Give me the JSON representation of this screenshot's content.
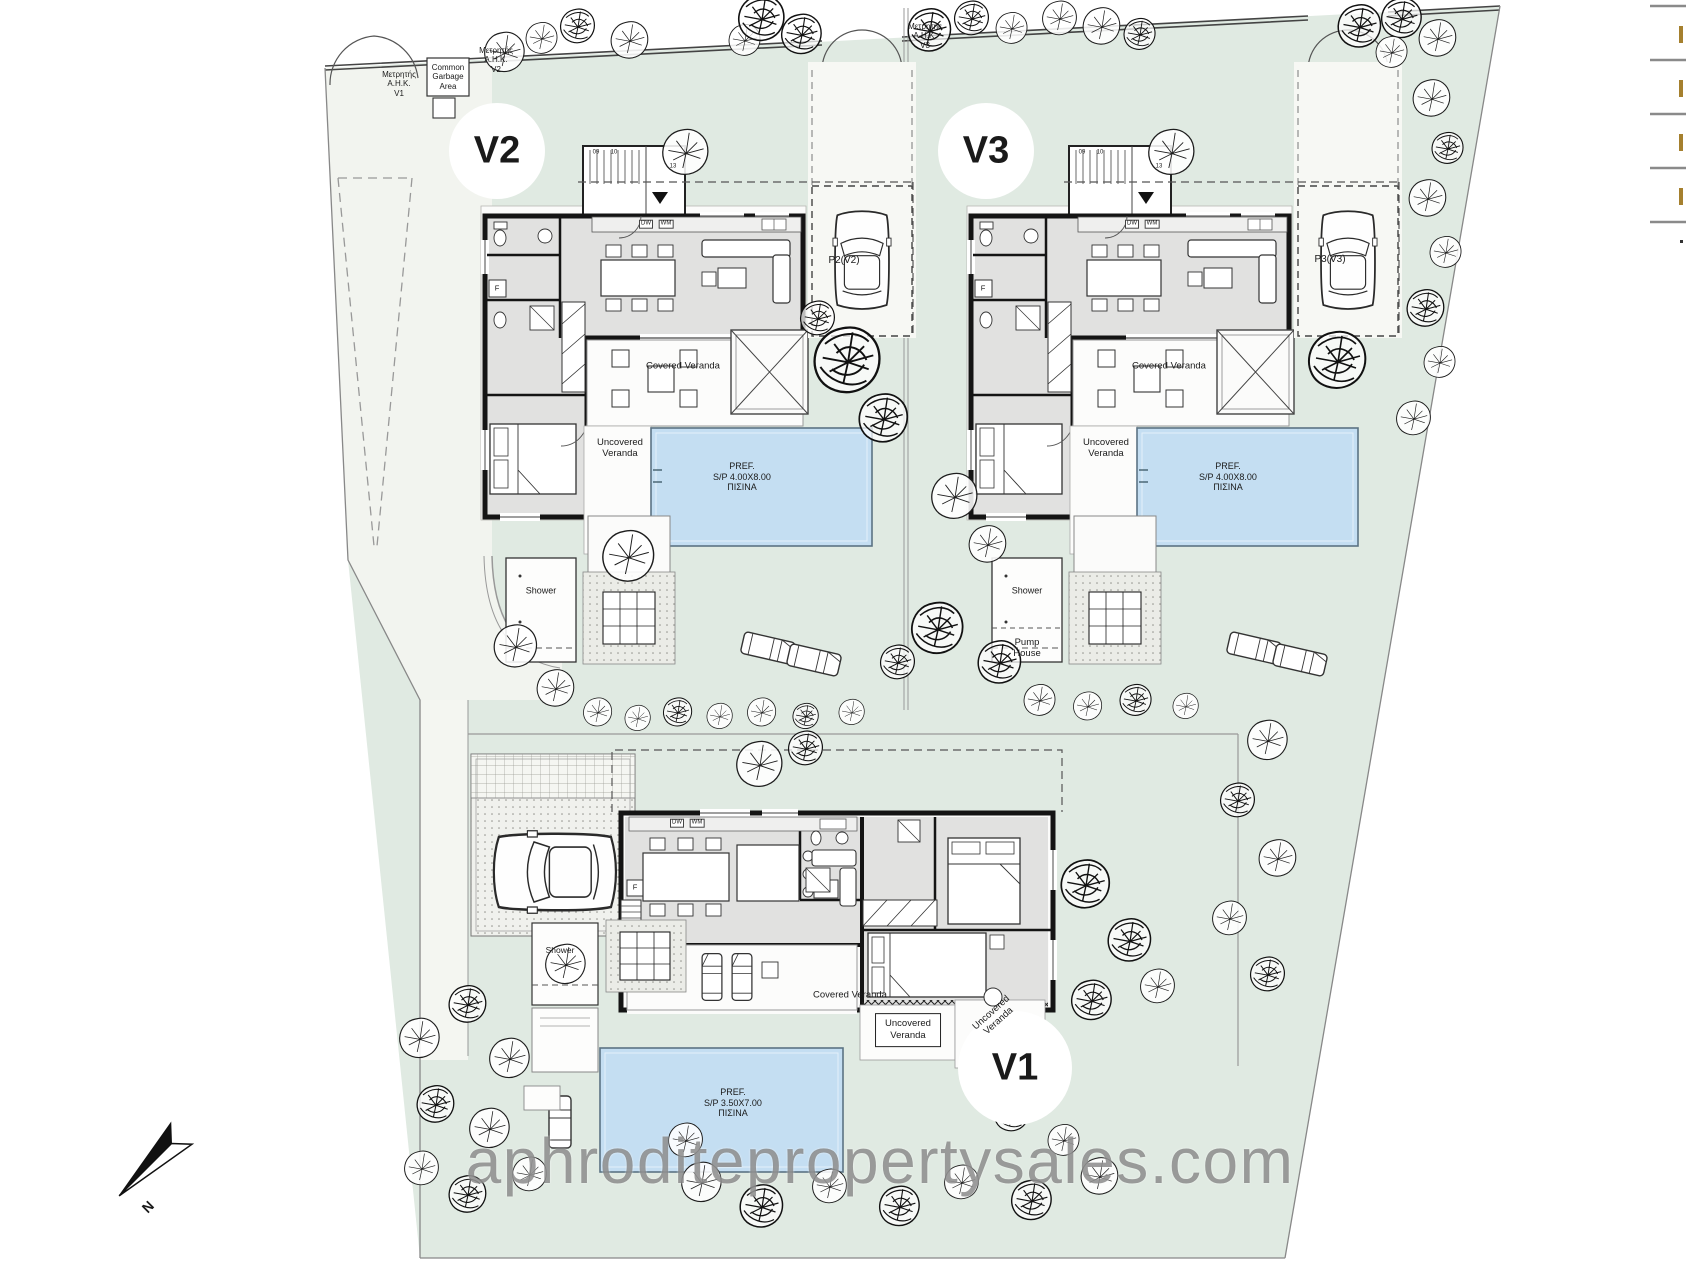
{
  "watermark": {
    "text": "aphroditepropertysales.com"
  },
  "colors": {
    "site_green": "#e0eae2",
    "pool_blue": "#c4def2",
    "paving": "#f2f4ef",
    "legend_mark": "#a5802e"
  },
  "villas": [
    {
      "id": "V2",
      "pool_label": "PREF.\nS/P 4.00X8.00\nΠΙΣΙΝΑ",
      "parking": "P2(V2)"
    },
    {
      "id": "V3",
      "pool_label": "PREF.\nS/P 4.00X8.00\nΠΙΣΙΝΑ",
      "parking": "P3(V3)"
    },
    {
      "id": "V1",
      "pool_label": "PREF.\nS/P 3.50X7.00\nΠΙΣΙΝΑ",
      "parking": ""
    }
  ],
  "labels": [
    {
      "name": "villa-v2-label",
      "text": "V2",
      "x": 497,
      "y": 151,
      "size": 38,
      "bold": true
    },
    {
      "name": "villa-v3-label",
      "text": "V3",
      "x": 986,
      "y": 151,
      "size": 38,
      "bold": true
    },
    {
      "name": "villa-v1-label",
      "text": "V1",
      "x": 1015,
      "y": 1068,
      "size": 38,
      "bold": true
    },
    {
      "name": "meter-v1-label",
      "text": "Μετρητής\nA.H.K.\nV1",
      "x": 399,
      "y": 84,
      "size": 8
    },
    {
      "name": "garbage-area-label",
      "text": "Common\nGarbage\nArea",
      "x": 448,
      "y": 77,
      "size": 8
    },
    {
      "name": "meter-v2-label",
      "text": "Μετρητής\nA.H.K.\nV2",
      "x": 496,
      "y": 60,
      "size": 8
    },
    {
      "name": "meter-v3-label",
      "text": "Μετρητής\nA.H.K.\nV3",
      "x": 925,
      "y": 36,
      "size": 8
    },
    {
      "name": "parking-v2-label",
      "text": "P2(V2)",
      "x": 844,
      "y": 261,
      "size": 10
    },
    {
      "name": "parking-v3-label",
      "text": "P3(V3)",
      "x": 1330,
      "y": 260,
      "size": 10
    },
    {
      "name": "covered-veranda-v2-label",
      "text": "Covered Veranda",
      "x": 683,
      "y": 366,
      "size": 9.5
    },
    {
      "name": "covered-veranda-v3-label",
      "text": "Covered Veranda",
      "x": 1169,
      "y": 366,
      "size": 9.5
    },
    {
      "name": "uncovered-veranda-v2-label",
      "text": "Uncovered\nVeranda",
      "x": 620,
      "y": 448,
      "size": 9.5
    },
    {
      "name": "uncovered-veranda-v3-label",
      "text": "Uncovered\nVeranda",
      "x": 1106,
      "y": 448,
      "size": 9.5
    },
    {
      "name": "pool-v2-label",
      "text": "PREF.\nS/P 4.00X8.00\nΠΙΣΙΝΑ",
      "x": 742,
      "y": 477,
      "size": 9
    },
    {
      "name": "pool-v3-label",
      "text": "PREF.\nS/P 4.00X8.00\nΠΙΣΙΝΑ",
      "x": 1228,
      "y": 477,
      "size": 9
    },
    {
      "name": "pool-v1-label",
      "text": "PREF.\nS/P 3.50X7.00\nΠΙΣΙΝΑ",
      "x": 733,
      "y": 1103,
      "size": 9
    },
    {
      "name": "shower-v2-label",
      "text": "Shower",
      "x": 541,
      "y": 591,
      "size": 9
    },
    {
      "name": "shower-v3-label",
      "text": "Shower",
      "x": 1027,
      "y": 591,
      "size": 9
    },
    {
      "name": "shower-v1-label",
      "text": "Shower",
      "x": 560,
      "y": 950,
      "size": 8.5
    },
    {
      "name": "pump-house-label",
      "text": "Pump\nHouse",
      "x": 1027,
      "y": 648,
      "size": 9.5
    },
    {
      "name": "covered-veranda-v1-label",
      "text": "Covered Veranda",
      "x": 850,
      "y": 995,
      "size": 9.5
    },
    {
      "name": "uncovered-veranda-v1-box",
      "text": "Uncovered\nVeranda",
      "x": 908,
      "y": 1030,
      "size": 9.5,
      "boxed": true
    },
    {
      "name": "uncovered-veranda-v1-diagonal",
      "text": "Uncovered\nVeranda",
      "x": 995,
      "y": 1017,
      "size": 9.5,
      "rotate": -42
    },
    {
      "name": "appliance-dw-v2",
      "text": "DW",
      "x": 646,
      "y": 224,
      "size": 6,
      "minibox": true
    },
    {
      "name": "appliance-wm-v2",
      "text": "WM",
      "x": 666,
      "y": 224,
      "size": 6,
      "minibox": true
    },
    {
      "name": "appliance-dw-v3",
      "text": "DW",
      "x": 1132,
      "y": 224,
      "size": 6,
      "minibox": true
    },
    {
      "name": "appliance-wm-v3",
      "text": "WM",
      "x": 1152,
      "y": 224,
      "size": 6,
      "minibox": true
    },
    {
      "name": "appliance-dw-v1",
      "text": "DW",
      "x": 677,
      "y": 823,
      "size": 6,
      "minibox": true
    },
    {
      "name": "appliance-wm-v1",
      "text": "WM",
      "x": 697,
      "y": 823,
      "size": 6,
      "minibox": true
    },
    {
      "name": "fridge-v2-label",
      "text": "F",
      "x": 497,
      "y": 289,
      "size": 7.5
    },
    {
      "name": "fridge-v3-label",
      "text": "F",
      "x": 983,
      "y": 289,
      "size": 7.5
    },
    {
      "name": "fridge-v1-label",
      "text": "F",
      "x": 635,
      "y": 888,
      "size": 7.5
    },
    {
      "name": "stair-num-09-v2",
      "text": "09",
      "x": 596,
      "y": 153,
      "size": 6
    },
    {
      "name": "stair-num-10-v2",
      "text": "10",
      "x": 614,
      "y": 153,
      "size": 6
    },
    {
      "name": "stair-num-13-v2",
      "text": "13",
      "x": 673,
      "y": 167,
      "size": 6
    },
    {
      "name": "stair-num-09-v3",
      "text": "09",
      "x": 1082,
      "y": 153,
      "size": 6
    },
    {
      "name": "stair-num-10-v3",
      "text": "10",
      "x": 1100,
      "y": 153,
      "size": 6
    },
    {
      "name": "stair-num-13-v3",
      "text": "13",
      "x": 1159,
      "y": 167,
      "size": 6
    },
    {
      "name": "north-label",
      "text": "N",
      "x": 148,
      "y": 1207,
      "size": 14,
      "rotate": -45,
      "bold": true
    }
  ]
}
